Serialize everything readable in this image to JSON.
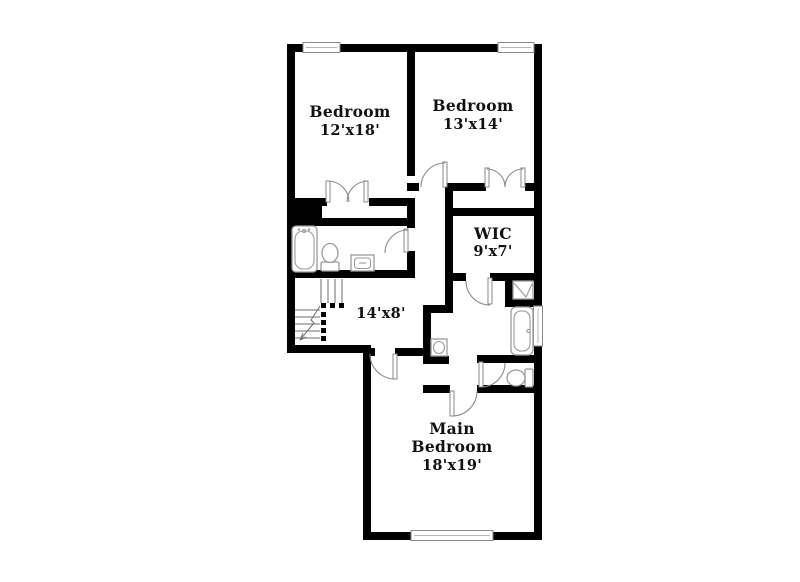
{
  "rooms": {
    "bedroom1": {
      "name": "Bedroom",
      "dims": "12'x18'"
    },
    "bedroom2": {
      "name": "Bedroom",
      "dims": "13'x14'"
    },
    "wic": {
      "name": "WIC",
      "dims": "9'x7'"
    },
    "hall": {
      "dims": "14'x8'"
    },
    "main_bedroom": {
      "name_line1": "Main",
      "name_line2": "Bedroom",
      "dims": "18'x19'"
    }
  },
  "colors": {
    "wall": "#000000",
    "label": "#111111",
    "door": "#8a8a8a",
    "fixture": "#9a9a9a",
    "window_frame": "#888888",
    "background": "#ffffff"
  }
}
